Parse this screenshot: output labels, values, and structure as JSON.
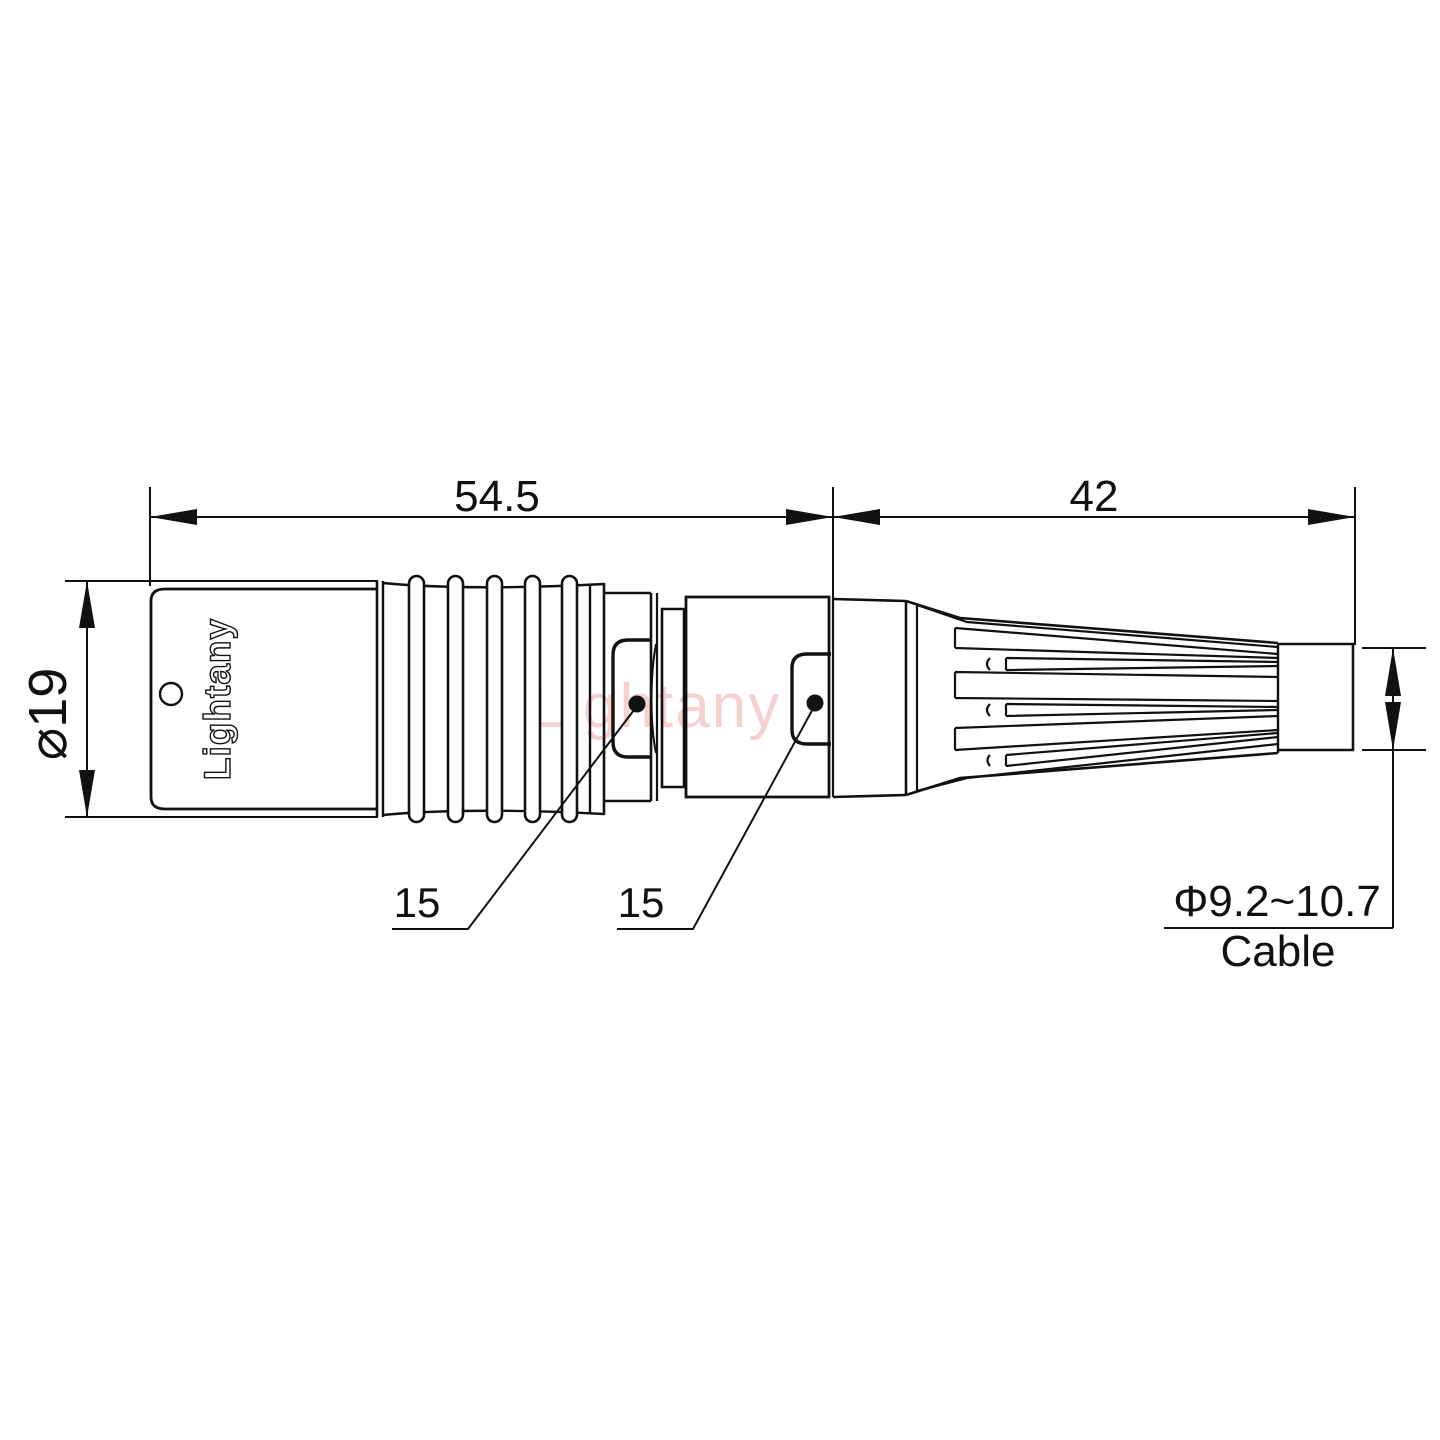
{
  "drawing": {
    "title_hint": "connector technical drawing",
    "watermark_text": "Lightany",
    "engraving_text": "Lightany",
    "dimensions": {
      "front_length": "54.5",
      "rear_length": "42",
      "body_diameter": "⌀19",
      "nut_front": "15",
      "nut_rear": "15",
      "cable_range": "Φ9.2~10.7",
      "cable_label": "Cable"
    },
    "colors": {
      "line": "#111111",
      "background": "#ffffff",
      "watermark": "#f4c6c6"
    }
  }
}
